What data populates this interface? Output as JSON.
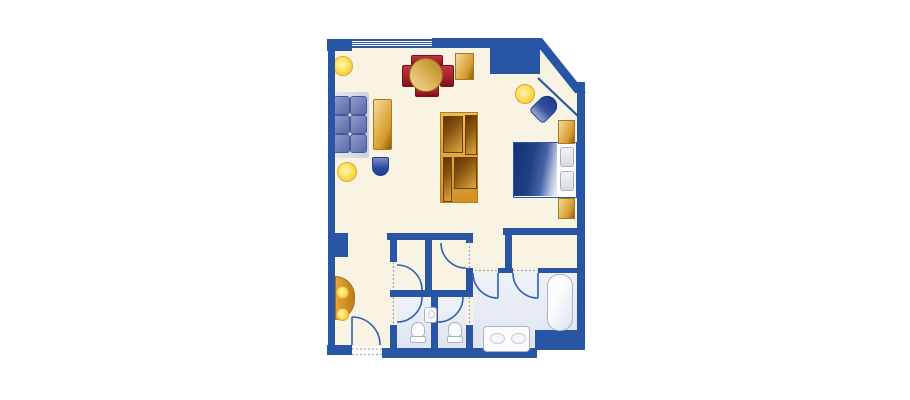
{
  "document": {
    "type": "floor-plan",
    "title": "hotel-suite-floor-plan",
    "background": "#FFFFFF",
    "visible_text": "none"
  },
  "palette": {
    "wall": "#2856A4",
    "line": "#3161AE",
    "dotted": "#9FA9C2",
    "floor": "#F8F3E2",
    "bath_floor_light": "#EEF1F8",
    "bath_floor": "#DEE5F1",
    "gold_light": "#F2DC9C",
    "gold": "#D79A2B",
    "gold_dark": "#8A5A14",
    "red_chair": "#A6202B",
    "red_chair_dark": "#7E1018",
    "lamp_yellow": "#FBD952",
    "lamp_yellow_light": "#FFF3A0",
    "sofa_blue": "#5A6AAC",
    "sofa_blue_light": "#8F9AC7",
    "sofa_back_gray": "#CDD0DA",
    "bed_blue_dark": "#14307E",
    "bed_blue": "#2C4A9C",
    "fixture_white": "#FBFBFD",
    "fixture_border": "#ACB2C0",
    "pillow_gray": "#ECEDF1"
  },
  "rooms": [
    {
      "name": "living-dining-room",
      "floor": "cream"
    },
    {
      "name": "bedroom-area",
      "floor": "cream"
    },
    {
      "name": "entry-hall",
      "floor": "cream"
    },
    {
      "name": "dressing-area",
      "floor": "cream"
    },
    {
      "name": "closet-left",
      "floor": "cream"
    },
    {
      "name": "closet-right",
      "floor": "cream"
    },
    {
      "name": "toilet-room-left",
      "floor": "light-blue"
    },
    {
      "name": "toilet-room-right",
      "floor": "light-blue"
    },
    {
      "name": "bathroom",
      "floor": "light-blue"
    }
  ],
  "furniture": [
    {
      "name": "sofa",
      "room": "living-dining-room",
      "color": "blue"
    },
    {
      "name": "coffee-table",
      "room": "living-dining-room",
      "color": "gold"
    },
    {
      "name": "ottoman",
      "room": "living-dining-room",
      "color": "blue"
    },
    {
      "name": "dining-table-round",
      "room": "living-dining-room",
      "color": "gold"
    },
    {
      "name": "dining-chair",
      "count": 4,
      "room": "living-dining-room",
      "color": "red"
    },
    {
      "name": "tall-cabinet",
      "room": "living-dining-room",
      "color": "gold"
    },
    {
      "name": "media-wall-unit",
      "room": "living-dining-room",
      "color": "gold"
    },
    {
      "name": "floor-lamp",
      "count": 3,
      "color": "yellow"
    },
    {
      "name": "double-bed",
      "room": "bedroom-area",
      "color": "blue-white"
    },
    {
      "name": "pillow",
      "count": 2,
      "room": "bedroom-area"
    },
    {
      "name": "nightstand",
      "count": 2,
      "room": "bedroom-area",
      "color": "gold"
    },
    {
      "name": "armchair",
      "room": "bedroom-area",
      "color": "blue"
    },
    {
      "name": "console-table",
      "room": "entry-hall",
      "color": "gold",
      "detail": "half-round with two lamps"
    }
  ],
  "fixtures": [
    {
      "name": "bathtub",
      "room": "bathroom"
    },
    {
      "name": "double-sink-vanity",
      "room": "bathroom"
    },
    {
      "name": "toilet",
      "count": 2,
      "rooms": [
        "toilet-room-left",
        "toilet-room-right"
      ]
    },
    {
      "name": "wall-sink",
      "room": "toilet-room-left"
    }
  ],
  "openings": {
    "windows": 1,
    "door_arcs": 7,
    "dotted_thresholds": 8,
    "corner_cut": "diagonal wall at top-right of bedroom"
  }
}
